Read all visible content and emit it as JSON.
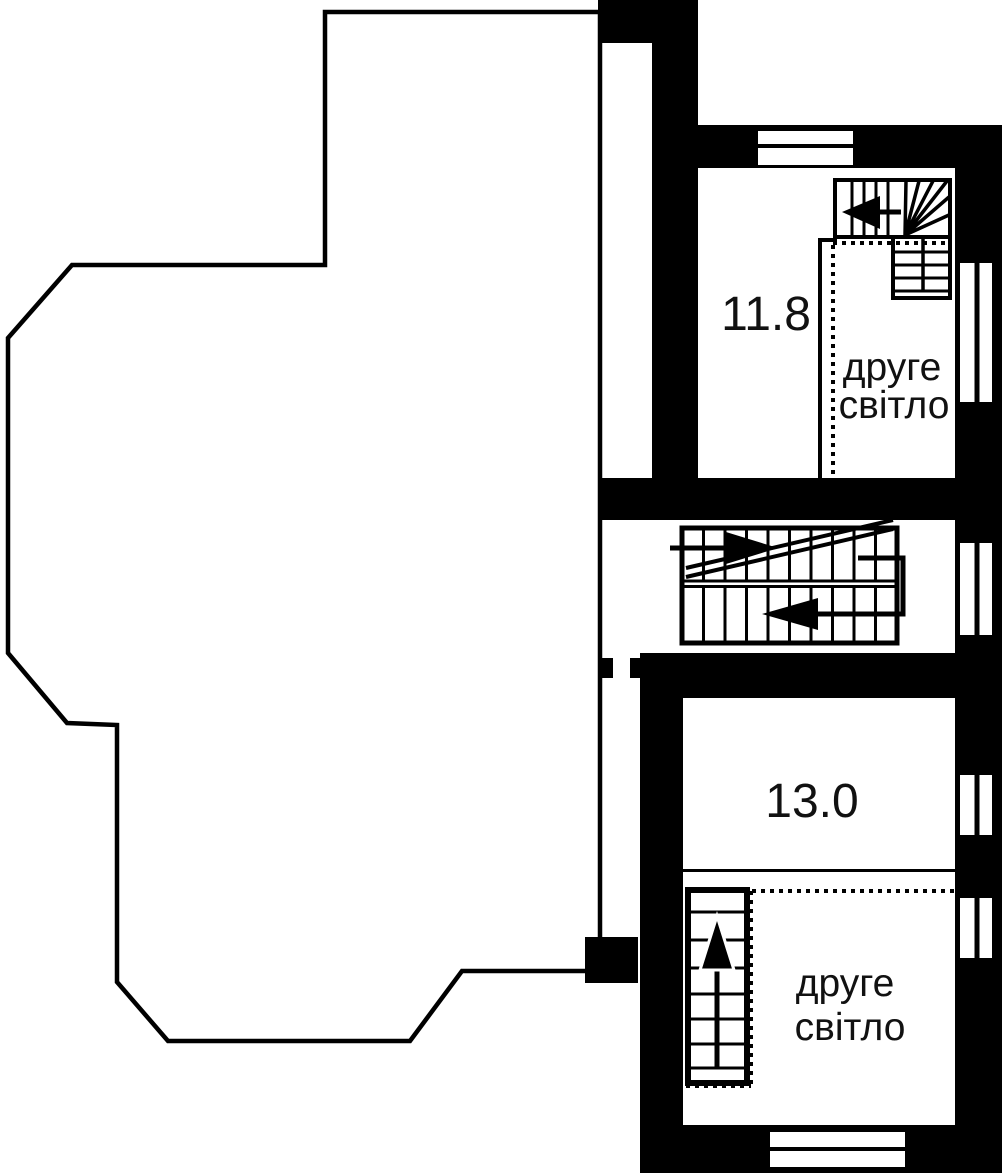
{
  "plan": {
    "colors": {
      "wall": "#000000",
      "background": "#ffffff",
      "text": "#111111"
    },
    "labels": {
      "upper_room_area": "11.8",
      "lower_room_area": "13.0",
      "upper_void_line1": "друге",
      "upper_void_line2": "світло",
      "lower_void_line1": "друге",
      "lower_void_line2": "світло"
    }
  }
}
